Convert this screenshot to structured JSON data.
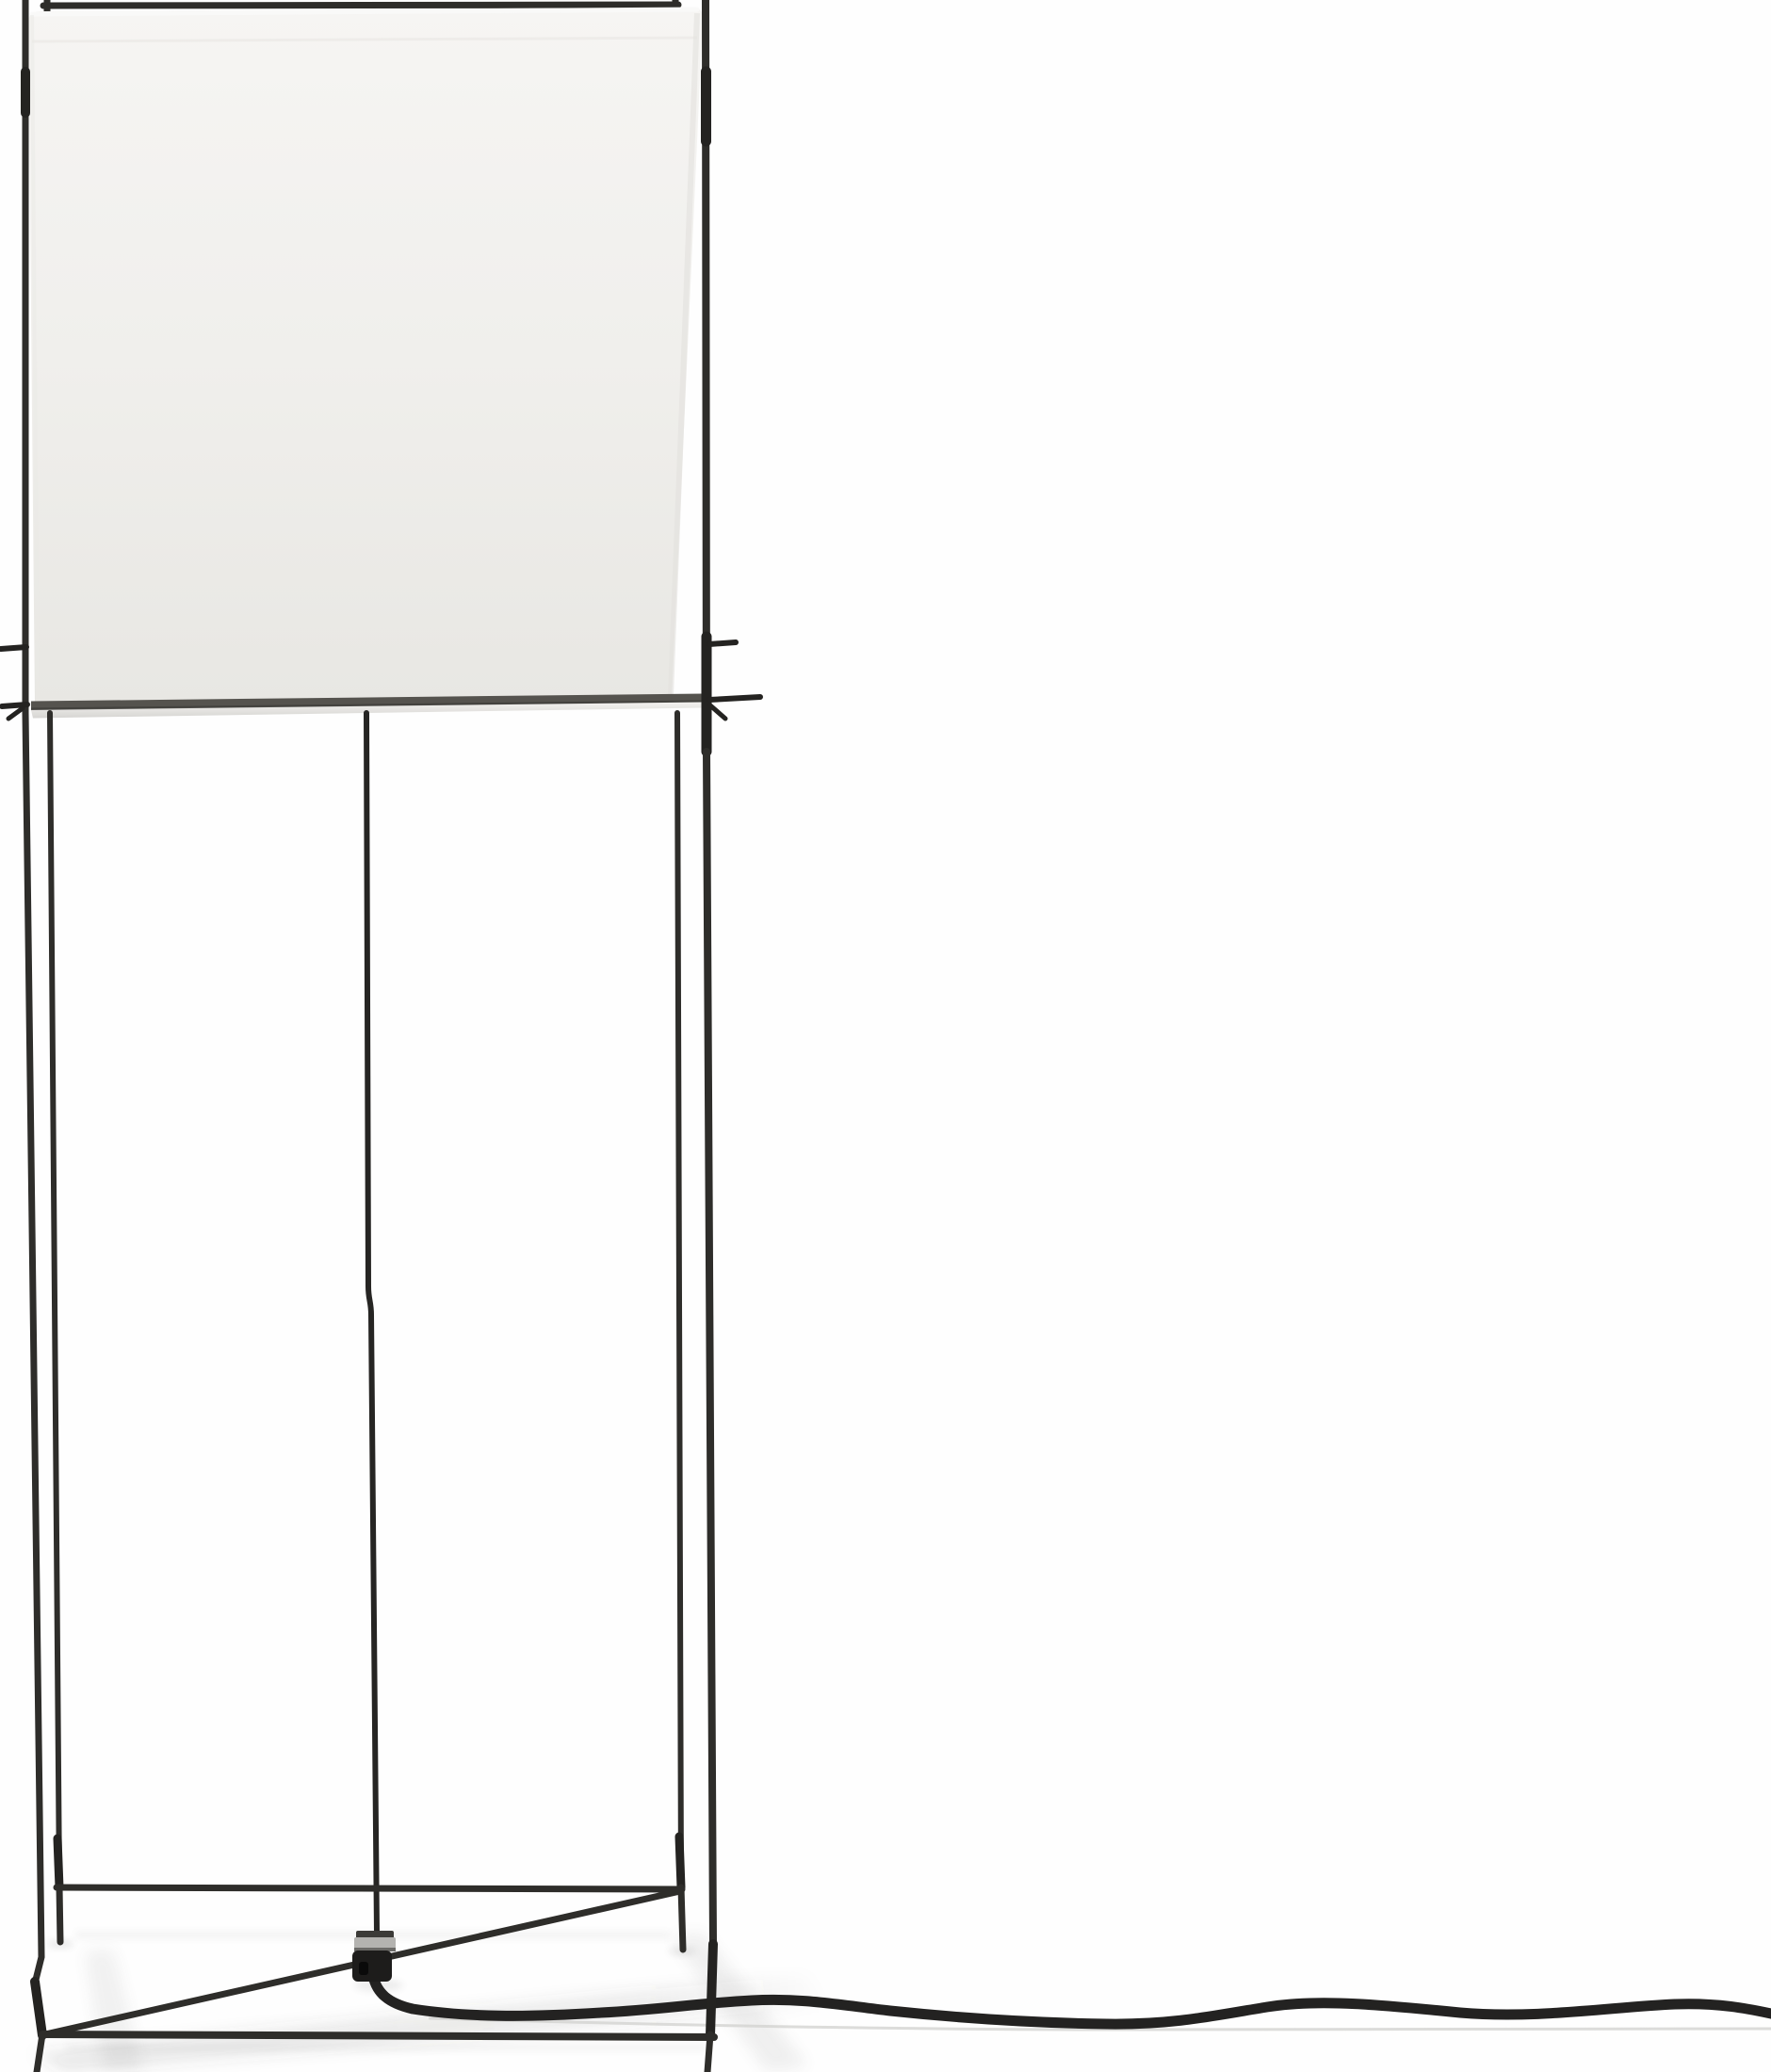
{
  "scene": {
    "kind": "product-photo",
    "subject": "Minimalist wire-frame floor lamp: square white linen shade suspended in a thin black steel rod frame, tall open four-leg tower, cross-braced floor base with cord connector, black power cable running along the floor to the right edge of the frame",
    "background": "#fefefe",
    "colors": {
      "frame": "#2e2d2a",
      "frame_dark": "#242321",
      "stem": "#262523",
      "shade_top": "#f6f5f3",
      "shade_mid": "#f0efec",
      "shade_bottom": "#e8e7e3",
      "shade_highlight": "#fafaf8",
      "shade_crease": "#e7e6e2",
      "shade_edge_right": "#e2e1dd",
      "shade_edge_left": "#eae9e6",
      "bottom_bar": "#55534e",
      "bottom_bar_edge": "#3e3d39",
      "hem_top": "#f3f2ef",
      "hem_bottom": "#d6d5d2",
      "cable": "#232221",
      "cable_shadow": "#d3d3d1",
      "connector": "#1d1c1b",
      "connector_hole": "#0a0a0a",
      "nut_metal": "#b4b3b0",
      "nut_dark": "#3c3b38",
      "nut_edge": "#6b6a67",
      "shadow_band": "#4a4a48"
    }
  }
}
